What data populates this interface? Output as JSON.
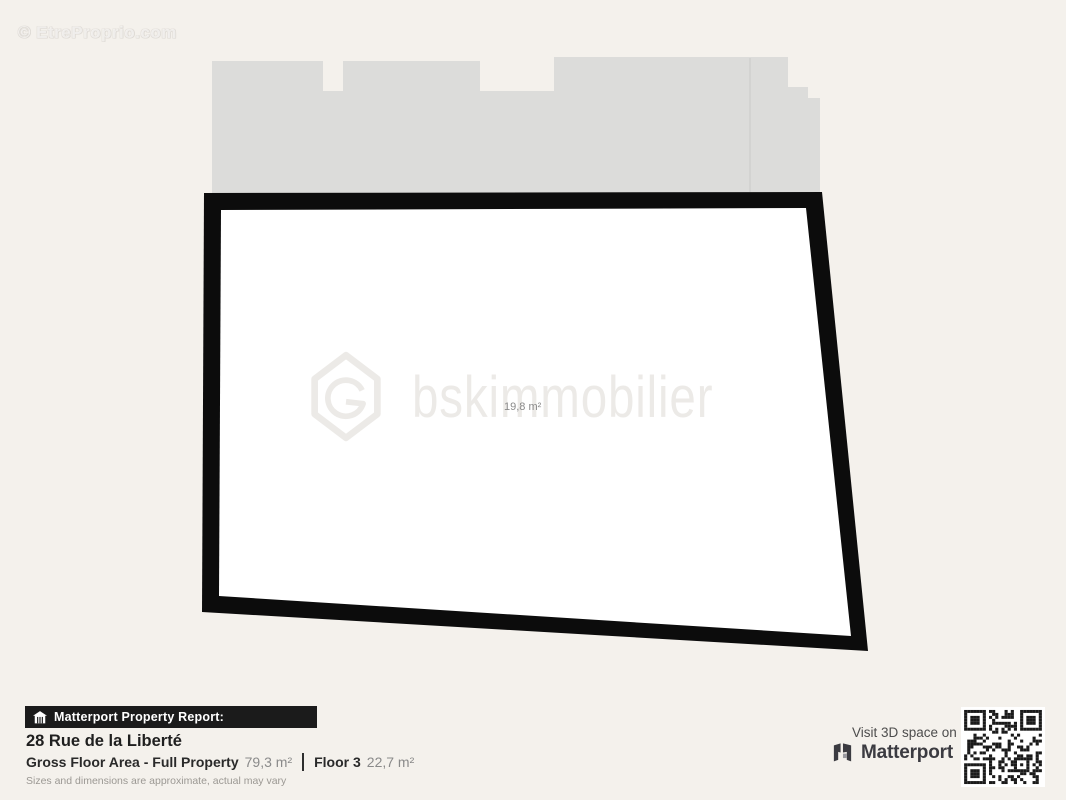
{
  "colors": {
    "background": "#f4f1ec",
    "building_mass": "#dcdcda",
    "plan_outline": "#0c0c0c",
    "plan_interior": "#ffffff",
    "report_bar_bg": "#1b1b1b",
    "text_dark": "#1f1f1f",
    "text_gray": "#8a8a8a",
    "matterport_brand": "#3b3b41"
  },
  "watermarks": {
    "corner": "© EtreProprio.com",
    "center_brand": "bskimmobilier"
  },
  "floorplan": {
    "room_area": "19,8 m²"
  },
  "report": {
    "bar_title": "Matterport Property Report:",
    "address": "28 Rue de la Liberté",
    "stats": [
      {
        "label": "Gross Floor Area - Full Property",
        "value": "79,3 m²"
      },
      {
        "label": "Floor 3",
        "value": "22,7 m²"
      }
    ],
    "disclaimer": "Sizes and dimensions are approximate, actual may vary"
  },
  "cta": {
    "visit_text": "Visit 3D space on",
    "brand": "Matterport"
  }
}
